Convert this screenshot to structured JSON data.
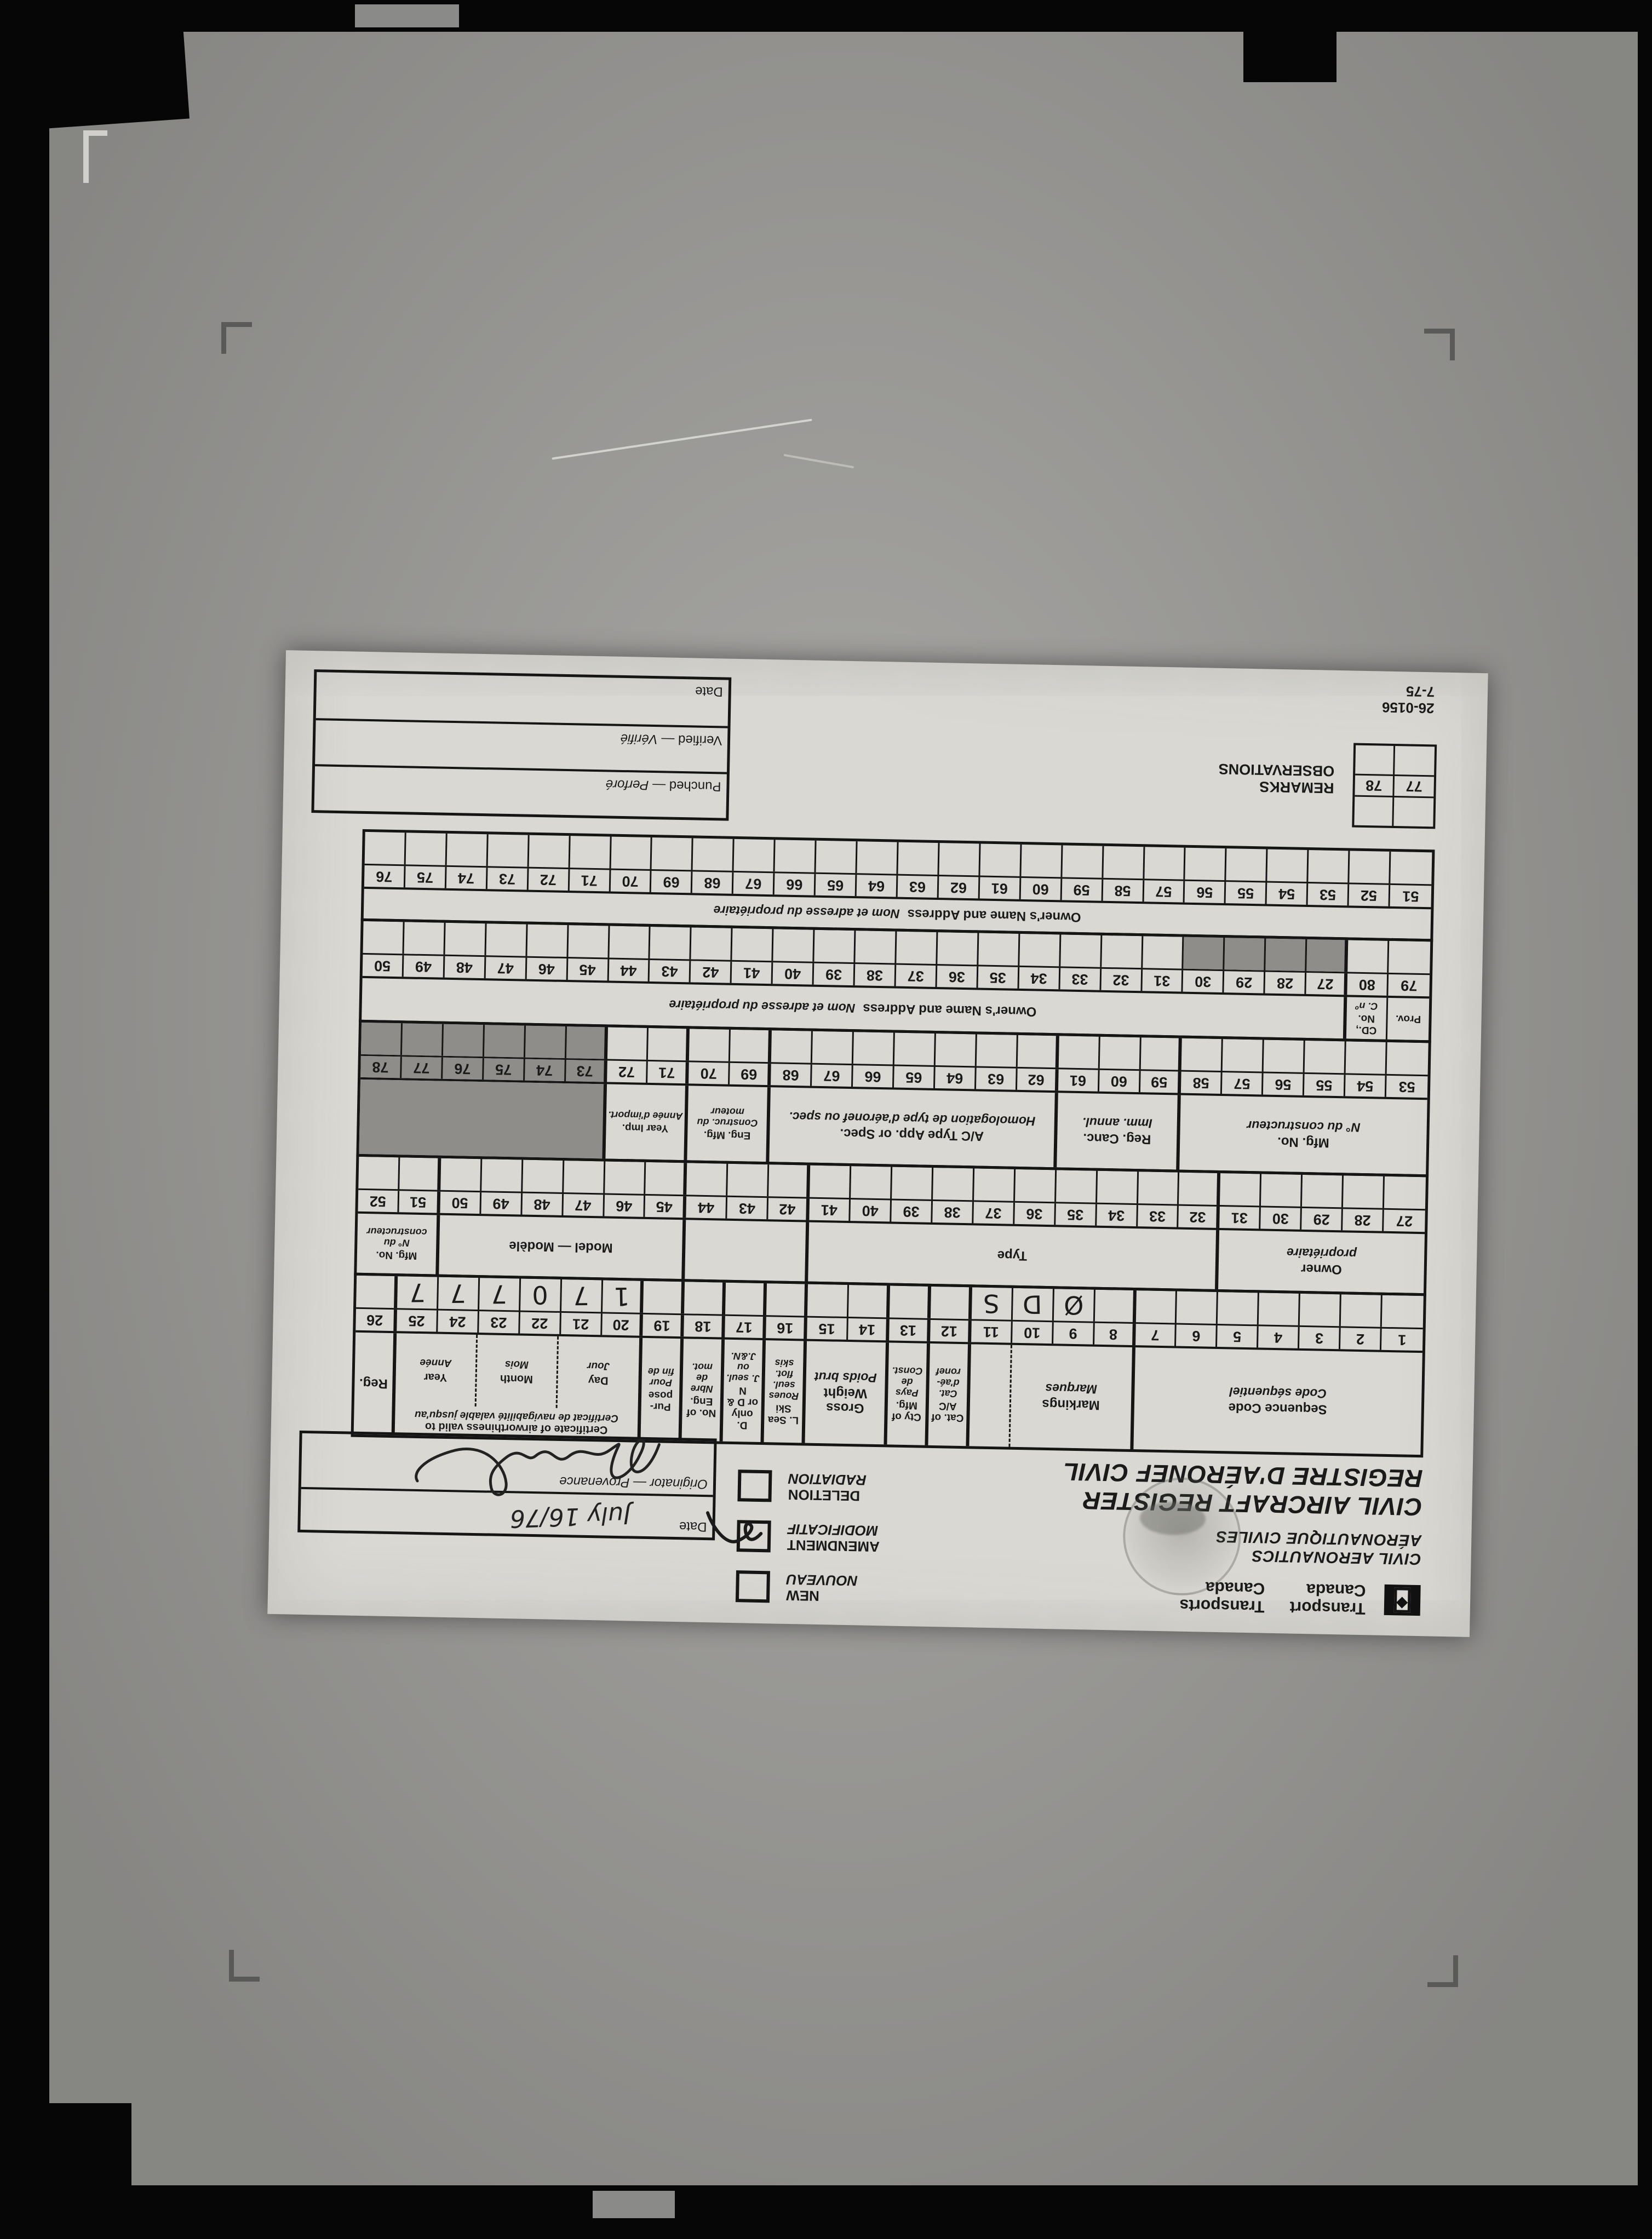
{
  "header": {
    "brand": {
      "en1": "Transport",
      "en2": "Canada",
      "fr1": "Transports",
      "fr2": "Canada"
    },
    "dept": {
      "en": "CIVIL AERONAUTICS",
      "fr": "AÉRONAUTIQUE CIVILES"
    },
    "title": {
      "en": "CIVIL AIRCRAFT REGISTER",
      "fr": "REGISTRE D'AÉRONEF CIVIL"
    },
    "checkboxes": [
      {
        "en": "NEW",
        "fr": "NOUVEAU",
        "checked": false
      },
      {
        "en": "AMENDMENT",
        "fr": "MODIFICATIF",
        "checked": true
      },
      {
        "en": "DELETION",
        "fr": "RADIATION",
        "checked": false
      }
    ],
    "date_box": {
      "date_label": "Date",
      "date_value": "July 16/76",
      "originator_label": "Originator — Provenance"
    }
  },
  "bands": [
    {
      "label_height": 190,
      "cells": [
        {
          "en": "Sequence Code",
          "fr": "Code séquentiel",
          "span": 7
        },
        {
          "en": "Markings",
          "fr": "Marques",
          "span": 3,
          "thick": true
        },
        {
          "en": "",
          "fr": "",
          "span": 1,
          "dashed": true
        },
        {
          "en": "Cat. of A/C",
          "fr": "Cat. d'aé- ronef",
          "span": 1,
          "small": true,
          "thick": true
        },
        {
          "en": "Cty of Mfg.",
          "fr": "Pays de Const.",
          "span": 1,
          "small": true,
          "thick": true
        },
        {
          "en": "Gross Weight",
          "fr": "Poids brut",
          "span": 2,
          "thick": true
        },
        {
          "en": "L. Sea Ski",
          "fr": "Roues seul. flot. skis",
          "span": 1,
          "small": true,
          "thick": true
        },
        {
          "en": "D. only or D & N",
          "fr": "J. seul. ou J.&N.",
          "span": 1,
          "small": true,
          "thick": true
        },
        {
          "en": "No. of Eng.",
          "fr": "Nbre de mot.",
          "span": 1,
          "small": true,
          "thick": true
        },
        {
          "en": "Pur- pose",
          "fr": "Pour fin de",
          "span": 1,
          "small": true,
          "thick": true
        },
        {
          "type": "cofa",
          "en": "Certificate of airworthiness valid to",
          "fr": "Certificat de navigabilité valable jusqu'au",
          "span": 6,
          "thick": true,
          "sub": [
            {
              "en": "Day",
              "fr": "Jour"
            },
            {
              "en": "Month",
              "fr": "Mois"
            },
            {
              "en": "Year",
              "fr": "Année"
            }
          ]
        },
        {
          "en": "Reg.",
          "fr": "",
          "span": 1,
          "thick": true
        }
      ],
      "numbers": [
        "1",
        "2",
        "3",
        "4",
        "5",
        "6",
        "7",
        "8",
        "9",
        "10",
        "11",
        "12",
        "13",
        "14",
        "15",
        "16",
        "17",
        "18",
        "19",
        "20",
        "21",
        "22",
        "23",
        "24",
        "25",
        "26"
      ],
      "thick_starts": [
        "8",
        "12",
        "13",
        "14",
        "16",
        "17",
        "18",
        "19",
        "20",
        "26"
      ],
      "values": {
        "9": "Ø",
        "10": "D",
        "11": "S",
        "20": "1",
        "21": "7",
        "22": "0",
        "23": "7",
        "24": "7",
        "25": "7"
      }
    },
    {
      "label_height": 112,
      "cells": [
        {
          "en": "Owner",
          "fr": "propriétaire",
          "span": 5
        },
        {
          "en": "Type",
          "fr": "",
          "span": 10,
          "thick": true
        },
        {
          "en": "",
          "fr": "",
          "span": 3,
          "thick": true
        },
        {
          "en": "Model — Modèle",
          "fr": "",
          "span": 6,
          "thick": true
        },
        {
          "en": "Mfg. No.",
          "fr": "N° du constructeur",
          "span": 2,
          "small": true,
          "thick": true
        }
      ],
      "numbers": [
        "27",
        "28",
        "29",
        "30",
        "31",
        "32",
        "33",
        "34",
        "35",
        "36",
        "37",
        "38",
        "39",
        "40",
        "41",
        "42",
        "43",
        "44",
        "45",
        "46",
        "47",
        "48",
        "49",
        "50",
        "51",
        "52"
      ],
      "thick_starts": [
        "32",
        "42",
        "45",
        "51"
      ],
      "values": {}
    },
    {
      "label_height": 140,
      "cells": [
        {
          "en": "Mfg. No.",
          "fr": "N° du constructeur",
          "span": 6
        },
        {
          "en": "Reg. Canc.",
          "fr": "Imm. annul.",
          "span": 3,
          "thick": true
        },
        {
          "en": "A/C Type App. or Spec.",
          "fr": "Homologation de type d'aéronef ou spec.",
          "span": 7,
          "thick": true
        },
        {
          "en": "Eng. Mfg.",
          "fr": "Construc. du moteur",
          "span": 2,
          "small": true,
          "thick": true
        },
        {
          "en": "Year Imp.",
          "fr": "Année d'import.",
          "span": 2,
          "small": true,
          "thick": true
        },
        {
          "en": "",
          "fr": "",
          "span": 6,
          "thick": true,
          "shaded": true
        }
      ],
      "numbers": [
        "53",
        "54",
        "55",
        "56",
        "57",
        "58",
        "59",
        "60",
        "61",
        "62",
        "63",
        "64",
        "65",
        "66",
        "67",
        "68",
        "69",
        "70",
        "71",
        "72",
        "73",
        "74",
        "75",
        "76",
        "77",
        "78"
      ],
      "thick_starts": [
        "59",
        "62",
        "69",
        "71",
        "73"
      ],
      "shaded_numbers": [
        "73",
        "74",
        "75",
        "76",
        "77",
        "78"
      ],
      "shaded_data": [
        "73",
        "74",
        "75",
        "76",
        "77",
        "78"
      ],
      "values": {}
    },
    {
      "label_height": 80,
      "cells": [
        {
          "en": "Prov.",
          "fr": "",
          "span": 1,
          "small": true
        },
        {
          "en": "CD., No.",
          "fr": "C. nº",
          "span": 1,
          "small": true
        },
        {
          "en": "Owner's Name and Address",
          "fr": "Nom et adresse du propriétaire",
          "span": 24,
          "inline": true,
          "thick": true
        }
      ],
      "numbers": [
        "79",
        "80",
        "27",
        "28",
        "29",
        "30",
        "31",
        "32",
        "33",
        "34",
        "35",
        "36",
        "37",
        "38",
        "39",
        "40",
        "41",
        "42",
        "43",
        "44",
        "45",
        "46",
        "47",
        "48",
        "49",
        "50"
      ],
      "thick_starts": [
        "27"
      ],
      "shaded_data": [
        "27",
        "28",
        "29",
        "30"
      ],
      "values": {}
    },
    {
      "label_height": 58,
      "cells": [
        {
          "en": "Owner's Name and Address",
          "fr": "Nom et adresse du propriétaire",
          "span": 26,
          "inline": true
        }
      ],
      "numbers": [
        "51",
        "52",
        "53",
        "54",
        "55",
        "56",
        "57",
        "58",
        "59",
        "60",
        "61",
        "62",
        "63",
        "64",
        "65",
        "66",
        "67",
        "68",
        "69",
        "70",
        "71",
        "72",
        "73",
        "74",
        "75",
        "76"
      ],
      "thick_starts": [],
      "values": {}
    }
  ],
  "remarks": {
    "en": "REMARKS",
    "fr": "OBSERVATIONS",
    "numbers": [
      "77",
      "78"
    ]
  },
  "process_box": {
    "rows": [
      {
        "en": "Punched",
        "fr": "Perforé"
      },
      {
        "en": "Verified",
        "fr": "Vérifié"
      },
      {
        "en": "Date",
        "fr": ""
      }
    ]
  },
  "form_number": {
    "line1": "26-0156",
    "line2": "7-75"
  }
}
